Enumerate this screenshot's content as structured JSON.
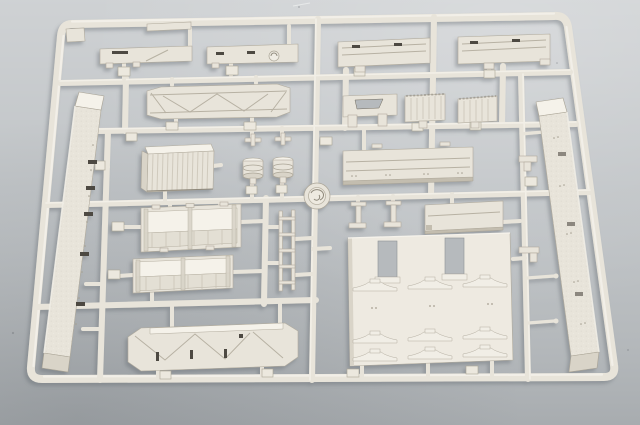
{
  "scene": {
    "description": "Photograph of an ivory-colored injection-molded plastic model kit sprue (runner frame) holding flat wagon panels, box bodies, beams, ladders and small fittings, lit from the upper right on a plain gray background",
    "object": "model-kit-sprue",
    "plastic_color_name": "ivory cream",
    "background_name": "neutral gray studio surface"
  },
  "colors": {
    "background_mid": "#bcc0c3",
    "background_top_light": "#d0d3d5",
    "background_bottom_dark": "#aeb2b5",
    "plastic_base": "#e8e4da",
    "plastic_light": "#f5f2ea",
    "plastic_mid": "#d9d4c8",
    "plastic_shade": "#c3bdaf",
    "plastic_edge": "#aaa496",
    "recess_dark": "#716b5e",
    "slot_dark": "#4e4a42",
    "window_opening": "#b6babd",
    "cast_shadow": "#6b7075"
  },
  "parts": [
    {
      "name": "outer-frame-rail",
      "description": "Rounded rectangular outer runner frame, slightly tilted by camera perspective"
    },
    {
      "name": "runner-grid",
      "description": "Internal horizontal and vertical runner bars feeding all parts"
    },
    {
      "name": "runner-hub-disc",
      "description": "Round molded disc with embossed mark at the central runner crossing"
    },
    {
      "name": "thin-strip-plate",
      "description": "Thin flat strip molded along the top rail"
    },
    {
      "name": "corner-tab-plate",
      "description": "Small plate inside the top-left frame corner"
    },
    {
      "name": "floor-plate-left",
      "description": "Long low plate with rectangular slot and engraved diagonal, top row left"
    },
    {
      "name": "floor-plate-right",
      "description": "Long low plate with two slots and a round hatch, top row right"
    },
    {
      "name": "plank-panel-left",
      "description": "Planked roof/floor panel with groove line, upper right area"
    },
    {
      "name": "plank-panel-right",
      "description": "Second planked panel with groove line, upper right corner"
    },
    {
      "name": "truss-roof-panel",
      "description": "Wide panel with beveled ends and engraved X-brace truss pattern"
    },
    {
      "name": "slotted-bracket-frame",
      "description": "Small frame part with trapezoidal opening and two legs"
    },
    {
      "name": "hopper-block-a",
      "description": "Small ribbed hopper block with serrated top edge"
    },
    {
      "name": "hopper-block-b",
      "description": "Second ribbed hopper block with serrated top edge"
    },
    {
      "name": "ribbed-box",
      "description": "Rectangular box with vertical corrugation and raised top face"
    },
    {
      "name": "buffer-drum-pair",
      "description": "Two flanged cylindrical buffer/winch drums with small H-brackets above"
    },
    {
      "name": "deck-slab",
      "description": "Thick grooved deck slab with rivet dots, middle right"
    },
    {
      "name": "hatch-plate",
      "description": "Small flat hatch plate below the deck slab"
    },
    {
      "name": "stanchion-pair",
      "description": "Two small T-shaped stanchion fittings"
    },
    {
      "name": "open-wagon-box-upper",
      "description": "Open-topped wagon body with corner posts and plank walls"
    },
    {
      "name": "open-wagon-box-lower",
      "description": "Second shallower open wagon body below the first"
    },
    {
      "name": "access-ladder",
      "description": "Narrow ladder with five rungs in the center column"
    },
    {
      "name": "chassis-beam-left",
      "description": "Long textured chassis beam running down the left side"
    },
    {
      "name": "chassis-beam-right",
      "description": "Long riveted chassis beam running down the right side"
    },
    {
      "name": "braced-side-girder",
      "description": "Side girder with top bar, diagonal braces and three slots, bottom center"
    },
    {
      "name": "bunker-wall-panel",
      "description": "Large wall panel with two window openings and three rows of saddle brackets"
    },
    {
      "name": "small-fittings-right",
      "description": "Small angle brackets and knob-ended pins along the right inner runner"
    },
    {
      "name": "part-number-tabs",
      "description": "Small embossed part-number tags molded beside the gates"
    },
    {
      "name": "sprue-gates",
      "description": "Short feed gates connecting every part to the runners"
    }
  ]
}
